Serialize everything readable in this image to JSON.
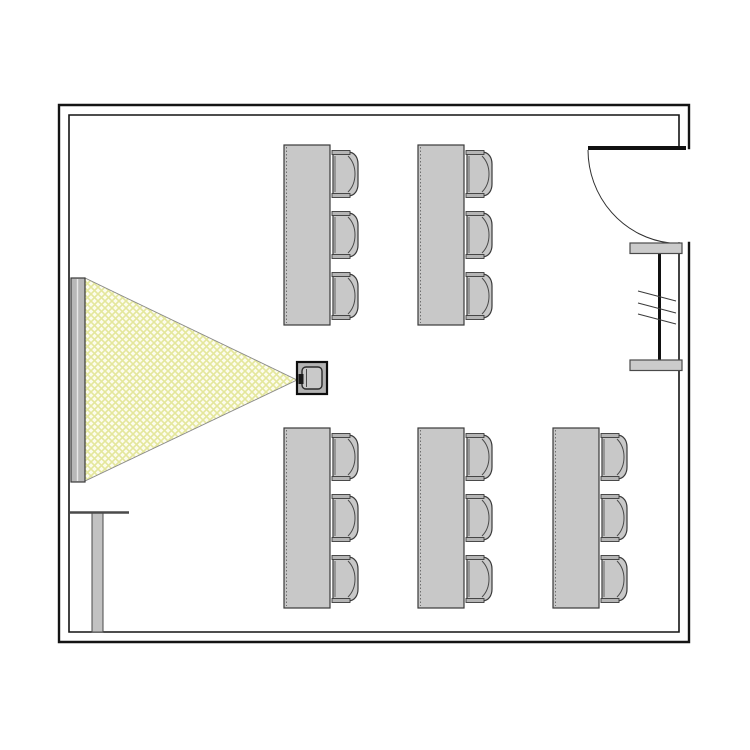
{
  "scene": {
    "canvas": {
      "width": 750,
      "height": 750,
      "background": "#ffffff"
    },
    "colors": {
      "wall_stroke": "#141414",
      "door_stroke": "#111111",
      "arc_stroke": "#2f2f2f",
      "furniture_fill": "#c8c8c8",
      "furniture_stroke": "#3a3a3a",
      "armrest_fill": "#b5b5b5",
      "detail_stroke": "#4a4a4a",
      "dotted_stroke": "#6e6e6e",
      "screen_fill": "#b8b8b8",
      "screen_stroke": "#3a3a3a",
      "screen_inner_line": "#e8e8e8",
      "beam_fill": "#fcfcee",
      "beam_hatch": "#e4e79c",
      "beam_stroke": "#8a8a8a",
      "cap_fill": "#cbcbcb",
      "projector_outer_fill": "#b3b3b3",
      "projector_outer_stroke": "#0d0d0d",
      "projector_inner_fill": "#c9c9c9",
      "projector_inner_stroke": "#2a2a2a",
      "lens_fill": "#1a1a1a",
      "side_table_fill": "#c2c2c2"
    },
    "walls": {
      "outer_path": "M689,148 L689,105 L59,105 L59,642 L689,642 L689,243",
      "inner_path": "M679,148 L679,115 L69,115 L69,632 L679,632 L679,243",
      "outer_width": 2.4,
      "inner_width": 1.6
    },
    "door": {
      "leaf": {
        "x1": 588,
        "y1": 148,
        "x2": 686,
        "y2": 148,
        "width": 4
      },
      "arc_path": "M588,150 A92,94 0 0 0 670,243",
      "arc_width": 1
    },
    "radiator": {
      "caps": [
        {
          "x": 630,
          "y": 243,
          "w": 52,
          "h": 10.5
        },
        {
          "x": 630,
          "y": 360,
          "w": 52,
          "h": 10.5
        }
      ],
      "center_line": {
        "x": 659.5,
        "y1": 243,
        "y2": 370,
        "width": 3
      },
      "hatches": [
        {
          "x1": 638,
          "y1": 291,
          "x2": 676,
          "y2": 301
        },
        {
          "x1": 638,
          "y1": 303,
          "x2": 676,
          "y2": 313
        },
        {
          "x1": 638,
          "y1": 314,
          "x2": 676,
          "y2": 324
        }
      ]
    },
    "projection_screen": {
      "x": 71,
      "y": 278,
      "w": 14,
      "h": 204,
      "inner_line_x": 77.5
    },
    "beam": {
      "points": "85,278 85,481 297,380",
      "hatch_size": 7,
      "hatch_width": 1.6
    },
    "projector": {
      "outer": {
        "x": 297,
        "y": 362,
        "w": 30,
        "h": 32
      },
      "inner": {
        "x": 302,
        "y": 367,
        "w": 20,
        "h": 22,
        "rx": 4
      },
      "lens": {
        "x": 298.5,
        "y": 374,
        "w": 5,
        "h": 10
      },
      "inner_line": {
        "x": 306.5,
        "y1": 369,
        "y2": 387
      }
    },
    "tables": [
      {
        "id": "table-top-left",
        "x": 284,
        "y": 145,
        "w": 46,
        "h": 180
      },
      {
        "id": "table-top-middle",
        "x": 418,
        "y": 145,
        "w": 46,
        "h": 180
      },
      {
        "id": "table-bottom-left",
        "x": 284,
        "y": 428,
        "w": 46,
        "h": 180
      },
      {
        "id": "table-bottom-middle",
        "x": 418,
        "y": 428,
        "w": 46,
        "h": 180
      },
      {
        "id": "table-bottom-right",
        "x": 553,
        "y": 428,
        "w": 46,
        "h": 180
      }
    ],
    "chair": {
      "w": 27,
      "h": 48,
      "gap_from_table": 2,
      "offsets": [
        5,
        66,
        127
      ]
    },
    "side_table": {
      "top_line": {
        "x1": 70,
        "y1": 512.5,
        "x2": 129,
        "y2": 512.5,
        "width": 2.6
      },
      "leg": {
        "x": 92,
        "y": 513,
        "w": 11,
        "h": 119
      }
    }
  }
}
